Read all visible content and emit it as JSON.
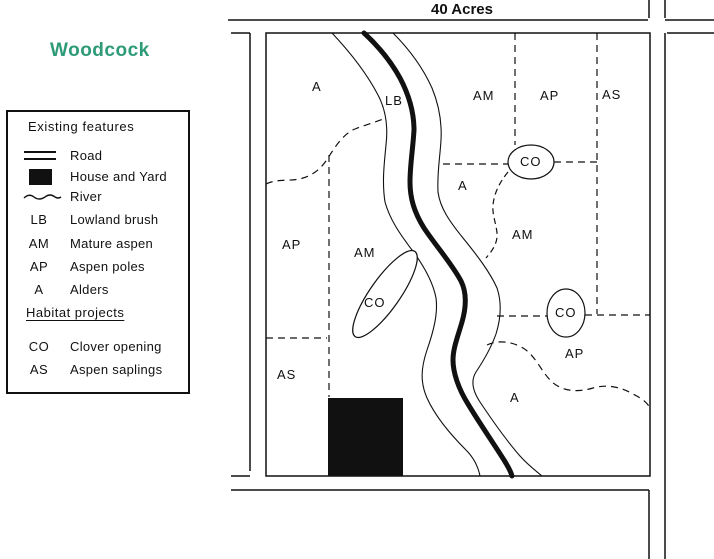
{
  "page": {
    "title": "Woodcock",
    "map_title": "40 Acres",
    "accent_color": "#2E9B78",
    "line_color": "#111111"
  },
  "legend": {
    "existing_title": "Existing features",
    "symbol_items": [
      {
        "symbol": "road-symbol",
        "label": "Road"
      },
      {
        "symbol": "house-symbol",
        "label": "House and Yard"
      },
      {
        "symbol": "river-symbol",
        "label": "River"
      }
    ],
    "existing_items": [
      {
        "abbr": "LB",
        "label": "Lowland brush"
      },
      {
        "abbr": "AM",
        "label": "Mature aspen"
      },
      {
        "abbr": "AP",
        "label": "Aspen poles"
      },
      {
        "abbr": "A",
        "label": "Alders"
      }
    ],
    "projects_title": "Habitat projects",
    "project_items": [
      {
        "abbr": "CO",
        "label": "Clover opening"
      },
      {
        "abbr": "AS",
        "label": "Aspen saplings"
      }
    ]
  },
  "map": {
    "labels": {
      "a_topleft": "A",
      "lb": "LB",
      "am_top": "AM",
      "ap_top": "AP",
      "as_top": "AS",
      "a_mid": "A",
      "co_upper": "CO",
      "am_right": "AM",
      "ap_left": "AP",
      "am_left": "AM",
      "co_tilted": "CO",
      "co_lower": "CO",
      "ap_right": "AP",
      "as_left": "AS",
      "a_bottom": "A"
    }
  }
}
